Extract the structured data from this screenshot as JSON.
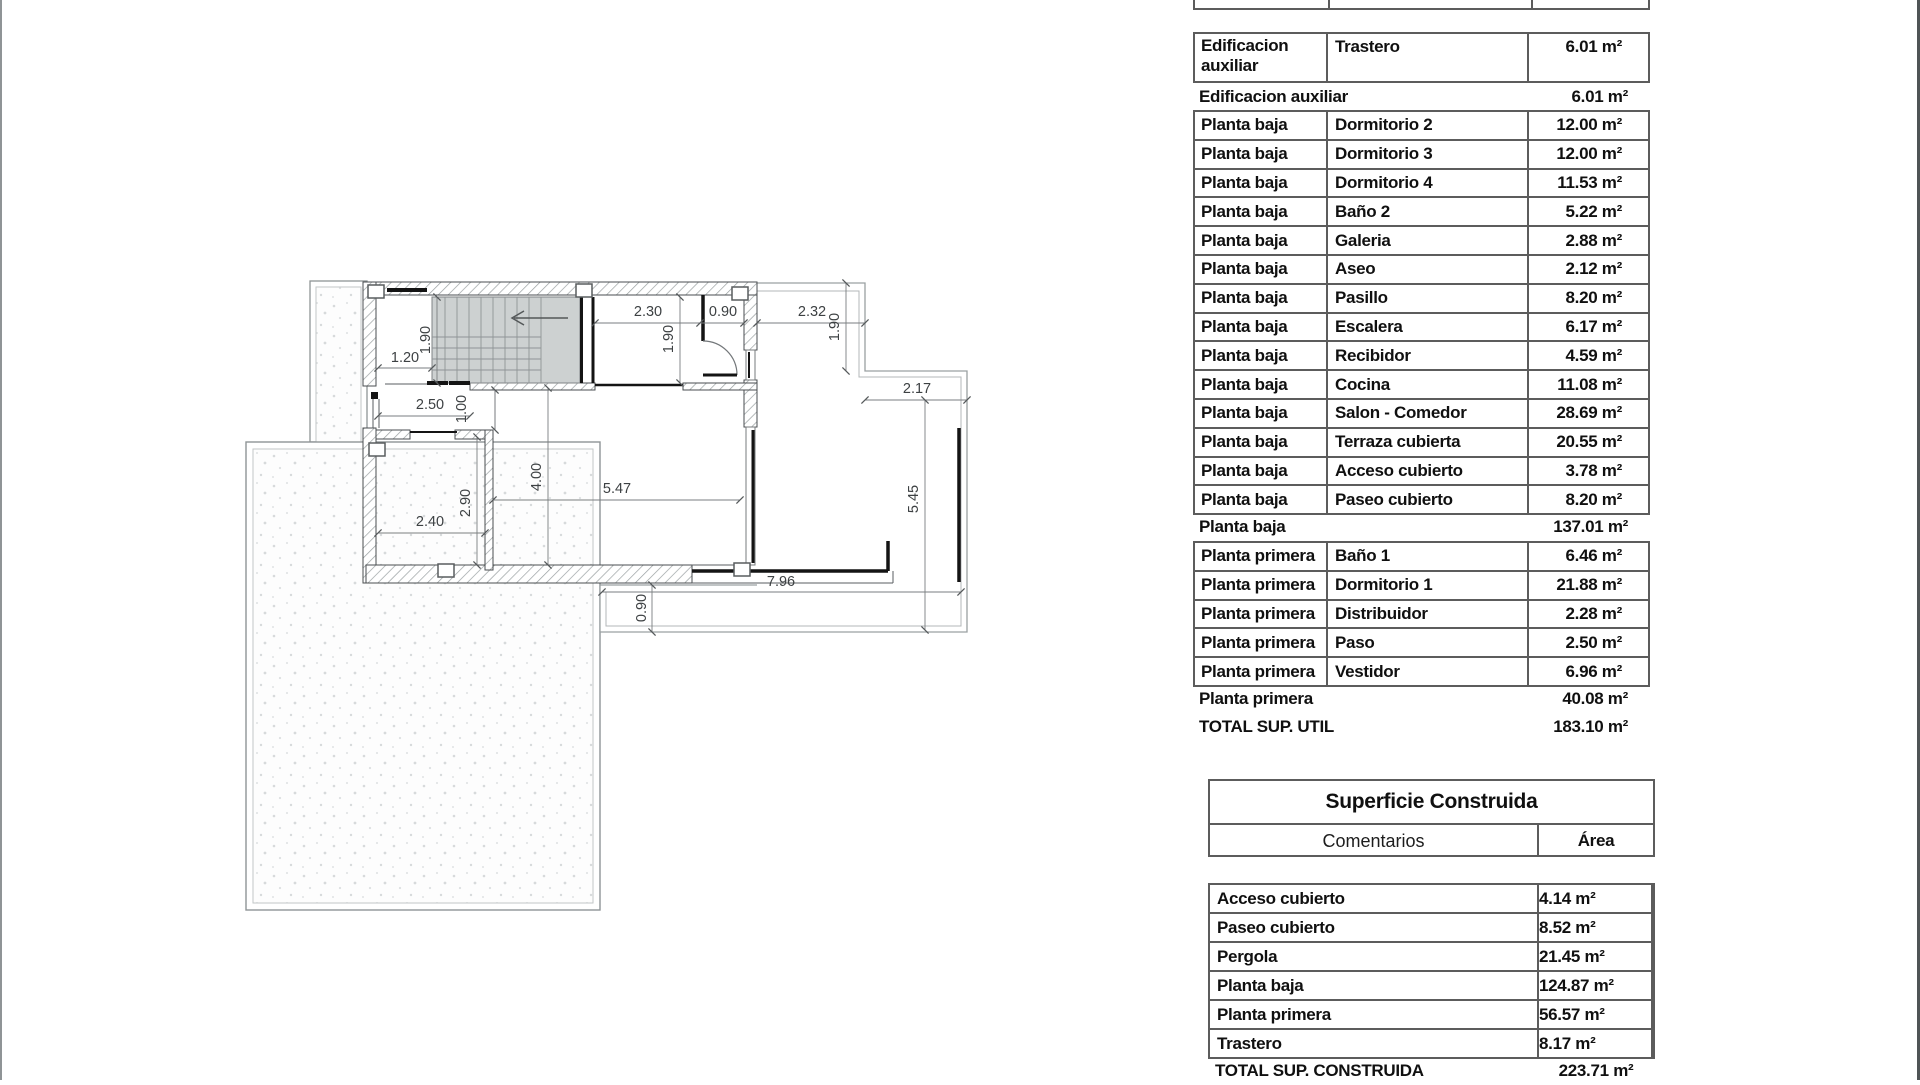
{
  "plan": {
    "dims": [
      "1.20",
      "1.90",
      "2.30",
      "0.90",
      "1.90",
      "2.32",
      "1.90",
      "2.17",
      "2.50",
      "1.00",
      "4.00",
      "5.47",
      "2.90",
      "2.40",
      "5.45",
      "7.96",
      "0.90"
    ]
  },
  "surface_util": {
    "first_row": {
      "floor": "Edificacion auxiliar",
      "room": "Trastero",
      "area": "6.01 m²"
    },
    "subtotal_aux": {
      "label": "Edificacion auxiliar",
      "area": "6.01 m²"
    },
    "baja_rows": [
      {
        "floor": "Planta baja",
        "room": "Dormitorio 2",
        "area": "12.00 m²"
      },
      {
        "floor": "Planta baja",
        "room": "Dormitorio 3",
        "area": "12.00 m²"
      },
      {
        "floor": "Planta baja",
        "room": "Dormitorio 4",
        "area": "11.53 m²"
      },
      {
        "floor": "Planta baja",
        "room": "Baño 2",
        "area": "5.22 m²"
      },
      {
        "floor": "Planta baja",
        "room": "Galeria",
        "area": "2.88 m²"
      },
      {
        "floor": "Planta baja",
        "room": "Aseo",
        "area": "2.12 m²"
      },
      {
        "floor": "Planta baja",
        "room": "Pasillo",
        "area": "8.20 m²"
      },
      {
        "floor": "Planta baja",
        "room": "Escalera",
        "area": "6.17 m²"
      },
      {
        "floor": "Planta baja",
        "room": "Recibidor",
        "area": "4.59 m²"
      },
      {
        "floor": "Planta baja",
        "room": "Cocina",
        "area": "11.08 m²"
      },
      {
        "floor": "Planta baja",
        "room": "Salon - Comedor",
        "area": "28.69 m²"
      },
      {
        "floor": "Planta baja",
        "room": "Terraza cubierta",
        "area": "20.55 m²"
      },
      {
        "floor": "Planta baja",
        "room": "Acceso cubierto",
        "area": "3.78 m²"
      },
      {
        "floor": "Planta baja",
        "room": "Paseo cubierto",
        "area": "8.20 m²"
      }
    ],
    "subtotal_baja": {
      "label": "Planta baja",
      "area": "137.01 m²"
    },
    "primera_rows": [
      {
        "floor": "Planta primera",
        "room": "Baño 1",
        "area": "6.46 m²"
      },
      {
        "floor": "Planta primera",
        "room": "Dormitorio 1",
        "area": "21.88 m²"
      },
      {
        "floor": "Planta primera",
        "room": "Distribuidor",
        "area": "2.28 m²"
      },
      {
        "floor": "Planta primera",
        "room": "Paso",
        "area": "2.50 m²"
      },
      {
        "floor": "Planta primera",
        "room": "Vestidor",
        "area": "6.96 m²"
      }
    ],
    "subtotal_primera": {
      "label": "Planta primera",
      "area": "40.08 m²"
    },
    "total": {
      "label": "TOTAL SUP. UTIL",
      "area": "183.10 m²"
    }
  },
  "construida": {
    "title": "Superficie Construida",
    "col_comment": "Comentarios",
    "col_area": "Área",
    "rows": [
      {
        "label": "Acceso cubierto",
        "area": "4.14 m²"
      },
      {
        "label": "Paseo cubierto",
        "area": "8.52 m²"
      },
      {
        "label": "Pergola",
        "area": "21.45 m²"
      },
      {
        "label": "Planta baja",
        "area": "124.87 m²"
      },
      {
        "label": "Planta primera",
        "area": "56.57 m²"
      },
      {
        "label": "Trastero",
        "area": "8.17 m²"
      }
    ],
    "total": {
      "label": "TOTAL SUP. CONSTRUIDA",
      "area": "223.71 m²"
    }
  }
}
